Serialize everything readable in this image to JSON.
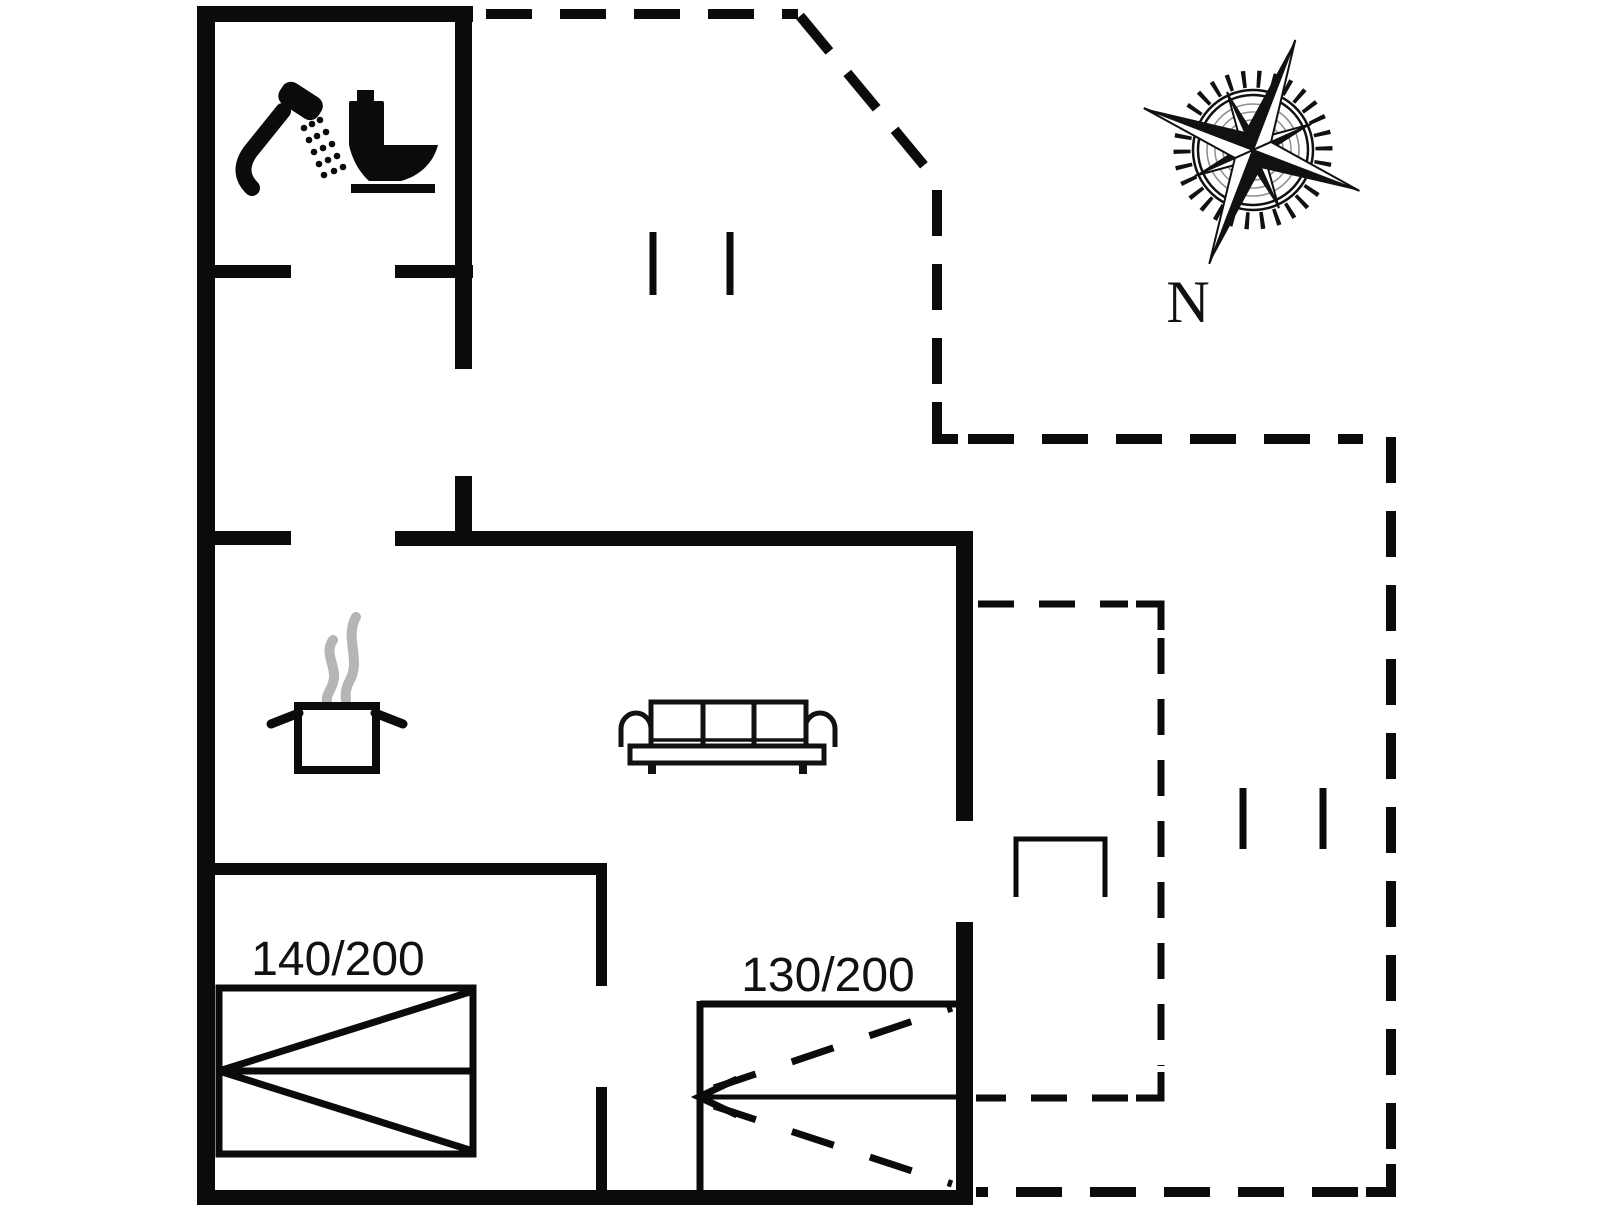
{
  "floor_plan": {
    "background_color": "#ffffff",
    "wall_color": "#0b0b0b",
    "steam_color": "#b5b5b5",
    "beds": [
      {
        "name": "double-bed",
        "size_label": "140/200"
      },
      {
        "name": "sofa-bed",
        "size_label": "130/200"
      }
    ],
    "compass": {
      "north_label": "N"
    },
    "icons": [
      "shower-icon",
      "toilet-icon",
      "cooking-pot-icon",
      "steam-icon",
      "sofa-icon",
      "compass-rose-icon",
      "window-mark",
      "entry-step"
    ]
  }
}
